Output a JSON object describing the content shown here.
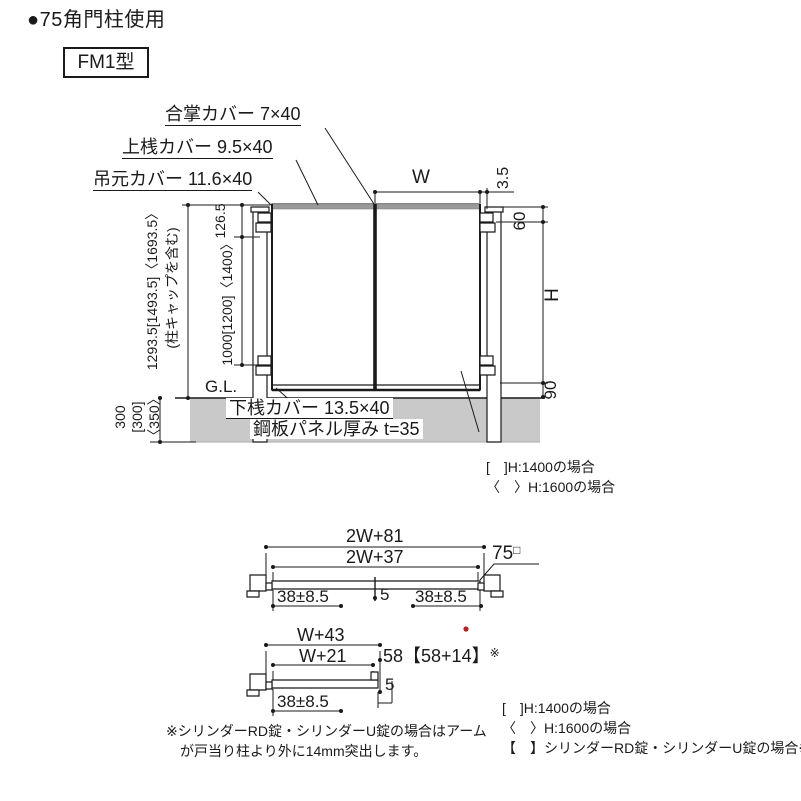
{
  "header": {
    "title": "●75角門柱使用",
    "model": "FM1型"
  },
  "elevation": {
    "labels": {
      "gassho_cover": "合掌カバー 7×40",
      "josan_cover": "上桟カバー 9.5×40",
      "tsurimoto_cover": "吊元カバー 11.6×40",
      "gesan_cover": "下桟カバー 13.5×40",
      "panel_thickness": "鋼板パネル厚み t=35",
      "ground_level": "G.L."
    },
    "dims": {
      "total_height": "1293.5[1493.5]〈1693.5〉",
      "total_height_note": "(柱キャップを含む)",
      "top_offset": "126.5",
      "hinge_span": "1000[1200]〈1400〉",
      "embed_1": "300",
      "embed_2": "[300]",
      "embed_3": "〈350〉",
      "width": "W",
      "gap": "3.5",
      "top": "60",
      "height": "H",
      "bottom": "90"
    },
    "notes": [
      "[　]H:1400の場合",
      "〈　〉H:1600の場合"
    ]
  },
  "plan_double": {
    "dim_outer": "2W+81",
    "dim_inner": "2W+37",
    "post_size": "75",
    "post_mark": "□",
    "dim_left": "38±8.5",
    "dim_center": "5",
    "dim_right": "38±8.5"
  },
  "plan_single": {
    "dim_outer": "W+43",
    "dim_inner": "W+21",
    "dim_stop": "58【58+14】",
    "dim_stop_ref": "※",
    "dim_left": "38±8.5",
    "dim_gap": "5"
  },
  "footnote": {
    "line1": "※シリンダーRD錠・シリンダーU錠の場合はアーム",
    "line2": "が戸当り柱より外に14mm突出します。"
  },
  "legend": [
    "[　]H:1400の場合",
    "〈　〉H:1600の場合",
    "【　】シリンダーRD錠・シリンダーU錠の場合※"
  ],
  "colors": {
    "line": "#1a1a1a",
    "ground": "#c9c9c9",
    "rail": "#9a9a9a",
    "mark_red": "#b22222"
  }
}
